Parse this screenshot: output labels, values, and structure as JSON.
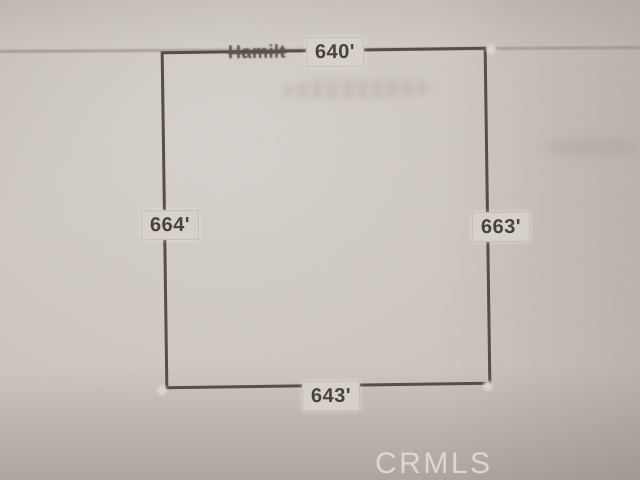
{
  "plat": {
    "street_label": "Hamilt",
    "dimensions": {
      "top": "640'",
      "left": "664'",
      "right": "663'",
      "bottom": "643'"
    }
  },
  "watermark": {
    "text": "CRMLS"
  },
  "colors": {
    "paper": "#cdc7bf",
    "line": "#4d453e",
    "label_bg": "#d8d3cb",
    "label_text": "#3e3831",
    "street_text": "#534c45",
    "watermark_text": "#e8e2da"
  }
}
